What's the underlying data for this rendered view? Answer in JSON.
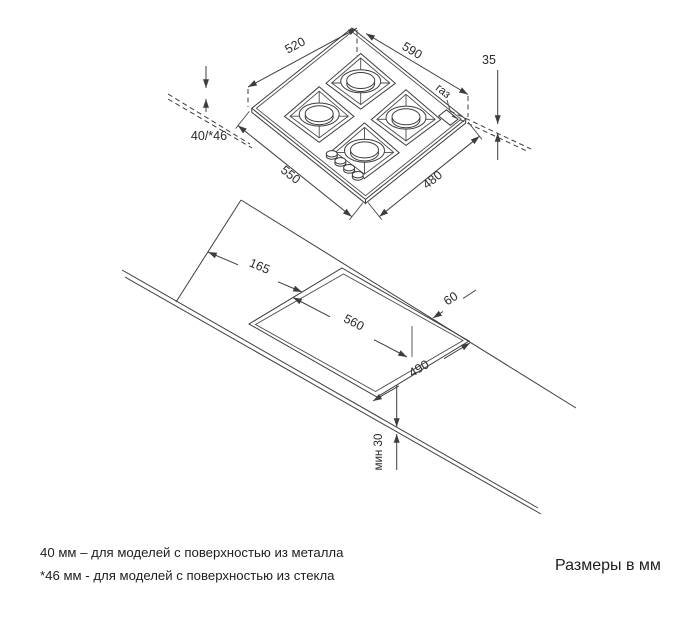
{
  "drawing": {
    "hob": {
      "edge_back_left": "520",
      "edge_back_right": "590",
      "height_above_counter": "35",
      "depth_below_counter": "40/*46",
      "edge_front_left": "550",
      "edge_front_right": "480",
      "gas_connection": "газ"
    },
    "cutout": {
      "offset_from_left_edge": "165",
      "width": "560",
      "depth": "490",
      "offset_from_back_edge": "60",
      "min_front_clearance": "мин 30"
    }
  },
  "footnotes": [
    "40 мм – для моделей с поверхностью из металла",
    "*46 мм - для моделей с поверхностью из стекла"
  ],
  "units_note": "Размеры в мм"
}
